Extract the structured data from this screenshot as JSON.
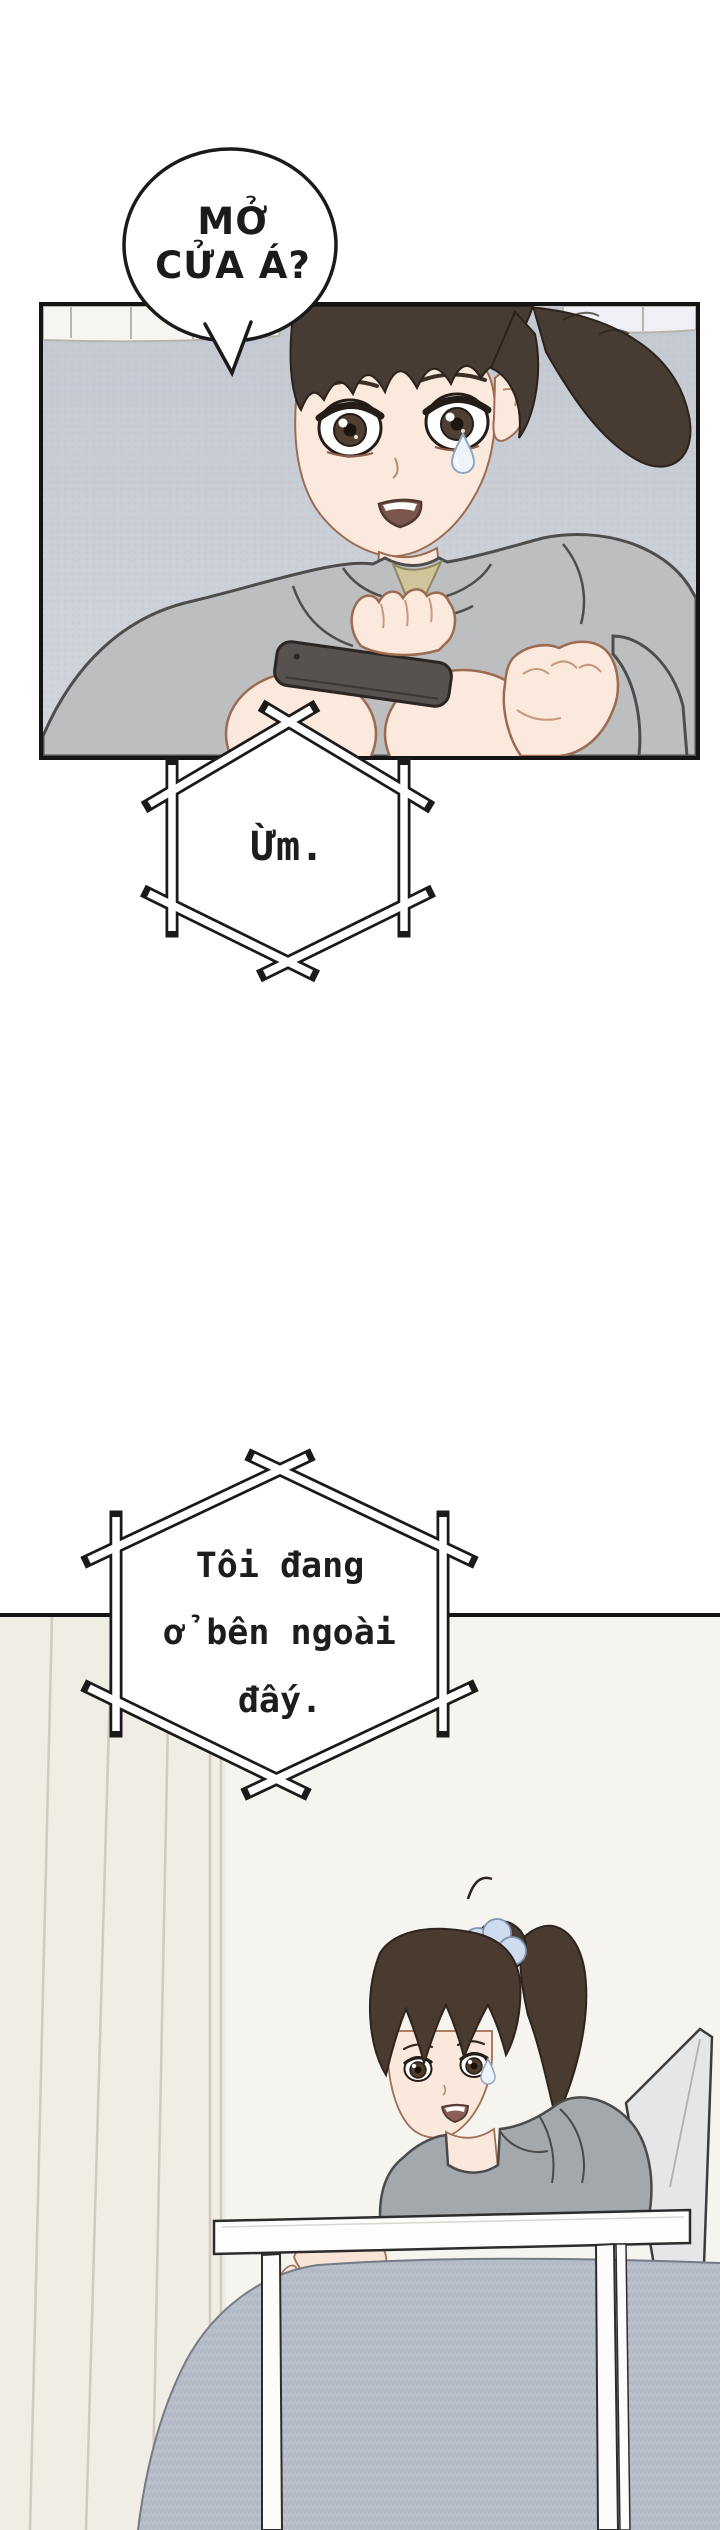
{
  "bubbles": {
    "shout": {
      "lines": [
        "MỞ",
        "CỬA Á?"
      ]
    },
    "hex_um": {
      "text": "Ừm."
    },
    "hex_outside": {
      "lines": [
        "Tôi đang",
        "ở bên ngoài",
        "đấy."
      ]
    }
  },
  "colors": {
    "panel_border": "#141414",
    "panel1_wall": "#c7ccd3",
    "tile_white": "#f6f5f1",
    "hair_dark": "#463c34",
    "skin": "#fae9dc",
    "hoodie_grey": "#bcbec0",
    "inner_shirt_olive": "#cfc49a",
    "phone_dark": "#57524f",
    "panel2_bg": "#f6f4ee",
    "panel2_wall": "#f0ede5",
    "scrunchie_blue": "#cfdcef",
    "hoodie2_grey": "#a3a8ad",
    "cushion_grey": "#b6bdc9",
    "table_white": "#fdfdfb",
    "chair_grey": "#e4e6e8",
    "sweat_blue": "#eef4fb"
  }
}
